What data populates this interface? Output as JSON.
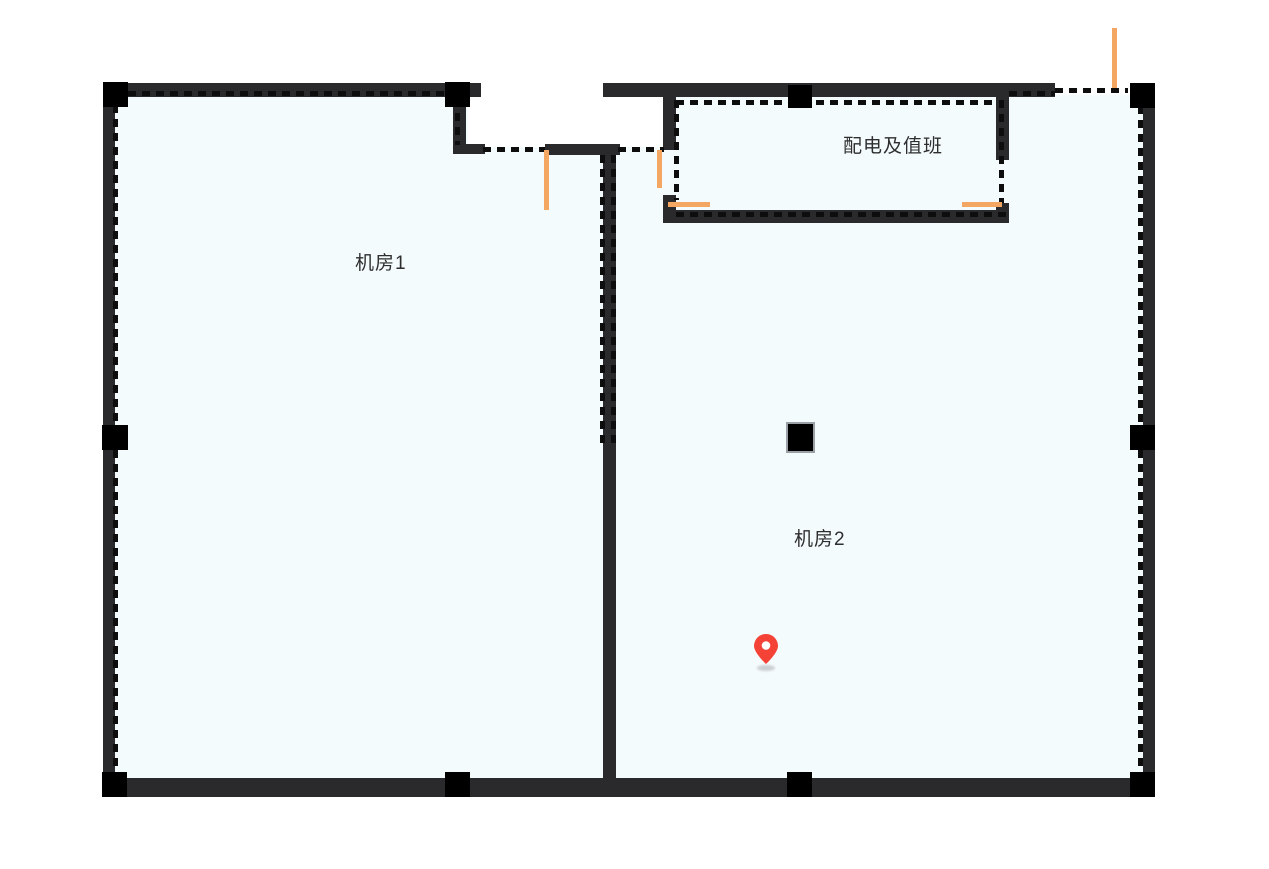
{
  "canvas": {
    "width": 1269,
    "height": 869
  },
  "floor_plan": {
    "rooms": [
      {
        "id": "room-1",
        "label": "机房1"
      },
      {
        "id": "room-2",
        "label": "机房2"
      },
      {
        "id": "room-3",
        "label": "配电及值班"
      }
    ],
    "marker": {
      "icon": "location-pin-icon",
      "color": "#f44336"
    }
  },
  "colors": {
    "background": "#ffffff",
    "room_fill": "#f4fbfc",
    "wall": "#2a2a2d",
    "column": "#000000",
    "dash": "#0d0d0d",
    "door_accent": "#f3a763",
    "marker_red": "#f44336",
    "label_text": "#2e2e2e"
  }
}
